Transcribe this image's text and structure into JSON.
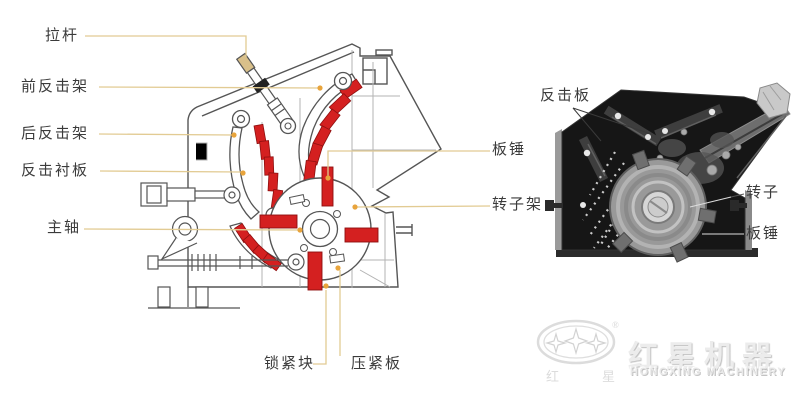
{
  "colors": {
    "liner_red": "#d42020",
    "leader_line_tan": "#e2cb93",
    "leader_dot_orange": "#e8a43c",
    "drawing_line_gray": "#555555",
    "photo_housing_black": "#161616",
    "watermark_gray": "#ececec",
    "label_text": "#3b3b3b"
  },
  "left_diagram": {
    "labels": {
      "la_gan": "拉杆",
      "qian_fan_ji_jia": "前反击架",
      "hou_fan_ji_jia": "后反击架",
      "fan_ji_chen_ban": "反击衬板",
      "zhu_zhou": "主轴",
      "suo_jin_kuai": "锁紧块",
      "ya_jin_ban": "压紧板",
      "ban_chui": "板锤",
      "zhuan_zi_jia": "转子架"
    }
  },
  "right_photo": {
    "labels": {
      "fan_ji_ban": "反击板",
      "zhuan_zi": "转子",
      "ban_chui": "板锤"
    }
  },
  "watermark": {
    "registered": "®",
    "emblem_left": "红",
    "emblem_right": "星",
    "brand_cn": "红星机器",
    "brand_en": "HONGXING MACHINERY"
  }
}
